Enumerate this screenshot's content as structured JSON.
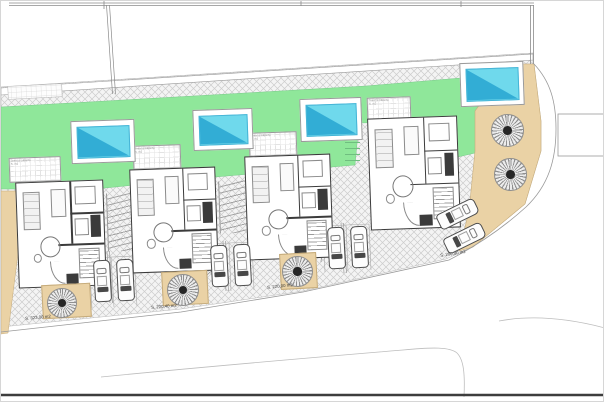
{
  "drawing": {
    "type": "residential site plan with four villas, pools, parking and palm trees",
    "units": [
      {
        "id": 1,
        "area_label": "S. 323,00 m2"
      },
      {
        "id": 2,
        "area_label": "S. 220,40 m2"
      },
      {
        "id": 3,
        "area_label": "S. 220,00 m2"
      },
      {
        "id": 4,
        "area_label": "S. 200,00 m2"
      }
    ],
    "terrace_label": {
      "line1": "Terraza cubierta",
      "line2": "S. m2"
    },
    "features": {
      "pools": 4,
      "palm_trees": 5,
      "parked_cars": 8
    }
  },
  "colors": {
    "lawn": "#8fe79a",
    "pool": "#6fd9ec",
    "pool_deep": "#2ba7d3",
    "sand": "#ead2a5",
    "wall": "#3b3b3b",
    "hatch": "#cdcdcd",
    "line": "#9a9a9a"
  }
}
